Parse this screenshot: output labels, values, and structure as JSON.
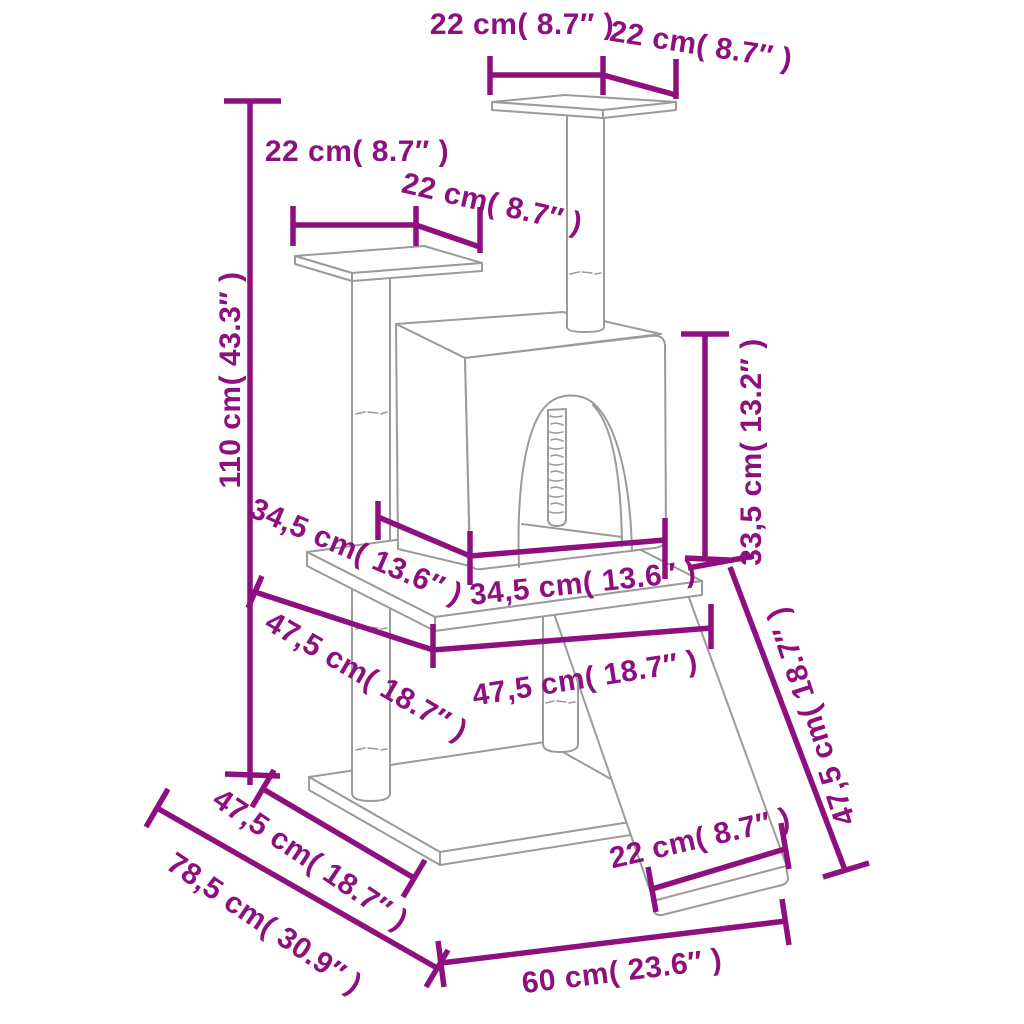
{
  "colors": {
    "dimension_lines": "#8D107E",
    "structure_lines": "#9B9B9B",
    "background": "#FFFFFF"
  },
  "labels": {
    "top_platform_width": "22 cm( 8.7″ )",
    "top_platform_depth": "22 cm( 8.7″ )",
    "perch_platform_width": "22 cm( 8.7″ )",
    "perch_platform_depth": "22 cm( 8.7″ )",
    "total_height": "110 cm( 43.3″ )",
    "condo_depth": "34,5 cm( 13.6″ )",
    "condo_width": "34,5 cm( 13.6″ )",
    "middle_level_depth": "47,5 cm( 18.7″ )",
    "middle_level_width": "47,5 cm( 18.7″ )",
    "condo_height": "33,5 cm( 13.2″ )",
    "ramp_length": "47,5 cm( 18.7″ )",
    "base_depth": "47,5 cm( 18.7″ )",
    "base_diagonal_depth": "78,5 cm( 30.9″ )",
    "base_width": "60 cm( 23.6″ )",
    "ramp_width": "22 cm( 8.7″ )"
  }
}
